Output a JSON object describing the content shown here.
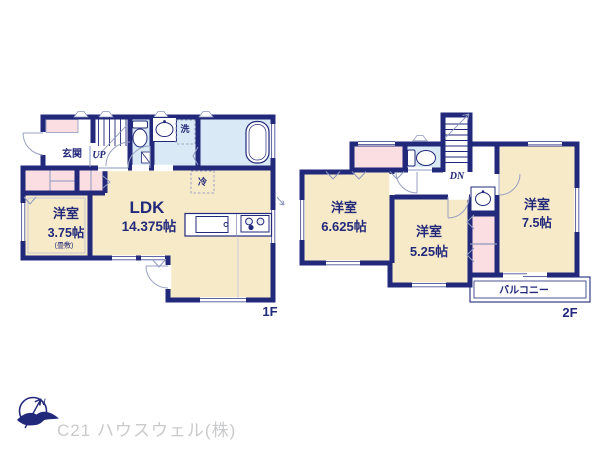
{
  "colors": {
    "wall_navy": "#23297a",
    "room_cream": "#f6eac9",
    "closet_pink": "#fadee2",
    "wet_blue": "#d9e9f6",
    "thin_line": "#8e98c0",
    "label_navy": "#23297a",
    "logo_gray": "#c9cacc"
  },
  "floor1": {
    "floor_label": "1F",
    "entrance": "玄関",
    "stairs": "UP",
    "washer": "洗",
    "fridge": "冷",
    "ldk_name": "LDK",
    "ldk_size": "14.375帖",
    "bedroom_name": "洋室",
    "bedroom_size": "3.75帖",
    "bedroom_note": "(畳敷)"
  },
  "floor2": {
    "floor_label": "2F",
    "stairs": "DN",
    "bedroom1_name": "洋室",
    "bedroom1_size": "6.625帖",
    "bedroom2_name": "洋室",
    "bedroom2_size": "5.25帖",
    "bedroom3_name": "洋室",
    "bedroom3_size": "7.5帖",
    "balcony": "バルコニー"
  },
  "footer": {
    "compass_north": "N",
    "company": "C21 ハウスウェル(株)"
  }
}
